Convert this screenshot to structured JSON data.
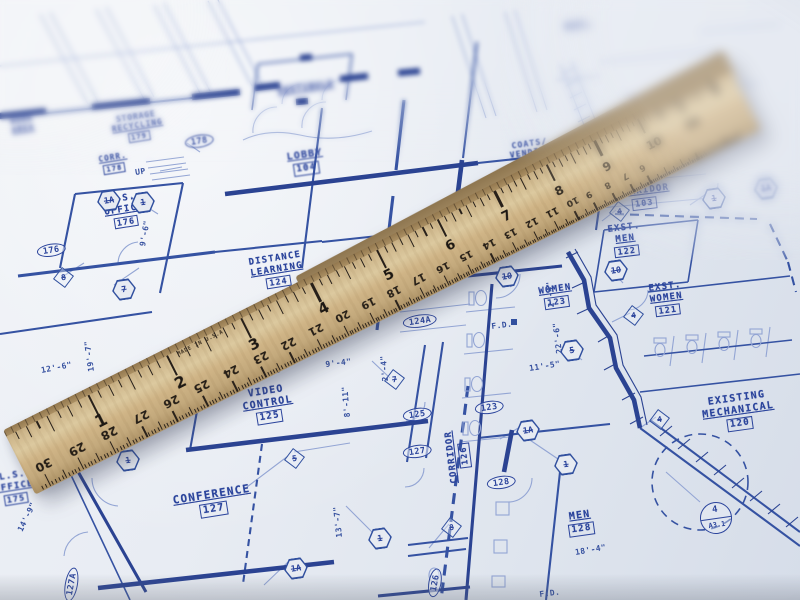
{
  "colors": {
    "paper": "#e8ecf2",
    "ink": "#2b449c",
    "ink_light": "#93a5d4",
    "wood": "#cdb68c",
    "tick": "#27201a"
  },
  "blueprint": {
    "rooms": [
      {
        "lines": [
          "WORK",
          "AREA"
        ],
        "number": "",
        "x": 10,
        "y": 118,
        "r": -9,
        "fs": 7.5,
        "blur": 1.6
      },
      {
        "lines": [
          "STORAGE",
          "RECYCLING"
        ],
        "number": "179",
        "x": 110,
        "y": 117,
        "r": -9,
        "fs": 7.5,
        "blur": 0.7
      },
      {
        "lines": [
          "CORR."
        ],
        "number": "178",
        "x": 98,
        "y": 156,
        "r": -9,
        "fs": 7.5,
        "blur": 0.5
      },
      {
        "lines": [
          "L.S.",
          "OFFICE"
        ],
        "number": "176",
        "x": 102,
        "y": 197,
        "r": -9,
        "fs": 9
      },
      {
        "lines": [
          "VESTIBULE"
        ],
        "number": "",
        "x": 277,
        "y": 87,
        "r": -8,
        "fs": 8.5,
        "blur": 1.5
      },
      {
        "lines": [
          "LOBBY"
        ],
        "number": "104",
        "x": 286,
        "y": 152,
        "r": -8,
        "fs": 10,
        "blur": 0.8
      },
      {
        "lines": [
          "COATS/",
          "VENDING"
        ],
        "number": "",
        "x": 508,
        "y": 142,
        "r": -8,
        "fs": 8,
        "blur": 0.6
      },
      {
        "lines": [
          "CORRIDOR"
        ],
        "number": "103",
        "x": 616,
        "y": 189,
        "r": -7,
        "fs": 9
      },
      {
        "lines": [
          "EXST.",
          "MEN"
        ],
        "number": "122",
        "x": 607,
        "y": 225,
        "r": -7,
        "fs": 9
      },
      {
        "lines": [
          "EXST.",
          "WOMEN"
        ],
        "number": "121",
        "x": 648,
        "y": 284,
        "r": -7,
        "fs": 9
      },
      {
        "lines": [
          "DISTANCE",
          "LEARNING"
        ],
        "number": "124",
        "x": 248,
        "y": 258,
        "r": -9,
        "fs": 9
      },
      {
        "lines": [
          "WOMEN"
        ],
        "number": "123",
        "x": 538,
        "y": 287,
        "r": -8,
        "fs": 9
      },
      {
        "lines": [
          "VIDEO",
          "CONTROL"
        ],
        "number": "125",
        "x": 240,
        "y": 390,
        "r": -9,
        "fs": 10
      },
      {
        "lines": [
          "CONFERENCE"
        ],
        "number": "127",
        "x": 172,
        "y": 495,
        "r": -9,
        "fs": 11
      },
      {
        "lines": [
          "MEN"
        ],
        "number": "128",
        "x": 566,
        "y": 512,
        "r": -8,
        "fs": 10
      },
      {
        "lines": [
          "EXISTING",
          "MECHANICAL"
        ],
        "number": "120",
        "x": 700,
        "y": 398,
        "r": -8,
        "fs": 10
      },
      {
        "lines": [
          "CORRIDOR"
        ],
        "number": "126",
        "x": 450,
        "y": 484,
        "r": -97,
        "fs": 9
      },
      {
        "lines": [
          "L.S.",
          "OFFICE"
        ],
        "number": "175",
        "x": -8,
        "y": 474,
        "r": -9,
        "fs": 9,
        "blur": 0.4
      },
      {
        "lines": [
          "EXST."
        ],
        "number": "",
        "x": 564,
        "y": 22,
        "r": -8,
        "fs": 7,
        "blur": 2
      }
    ],
    "door_tags": [
      {
        "t": "178",
        "x": 184,
        "y": 137,
        "r": -9,
        "blur": 0.7
      },
      {
        "t": "176",
        "x": 36,
        "y": 246,
        "r": -9
      },
      {
        "t": "124A",
        "x": 402,
        "y": 317,
        "r": -8
      },
      {
        "t": "125",
        "x": 402,
        "y": 410,
        "r": -8
      },
      {
        "t": "127",
        "x": 402,
        "y": 447,
        "r": -8
      },
      {
        "t": "123",
        "x": 474,
        "y": 403,
        "r": -8
      },
      {
        "t": "128",
        "x": 486,
        "y": 478,
        "r": -8
      },
      {
        "t": "127A",
        "x": 62,
        "y": 600,
        "r": -80
      },
      {
        "t": "126",
        "x": 426,
        "y": 596,
        "r": -80
      }
    ],
    "hex_markers": [
      {
        "t": "1A",
        "x": 97,
        "y": 190
      },
      {
        "t": "1",
        "x": 131,
        "y": 192
      },
      {
        "t": "7",
        "x": 112,
        "y": 279
      },
      {
        "t": "1",
        "x": 116,
        "y": 450
      },
      {
        "t": "1A",
        "x": 284,
        "y": 558
      },
      {
        "t": "1",
        "x": 368,
        "y": 528
      },
      {
        "t": "1",
        "x": 554,
        "y": 454
      },
      {
        "t": "1A",
        "x": 516,
        "y": 420
      },
      {
        "t": "10",
        "x": 495,
        "y": 266
      },
      {
        "t": "10",
        "x": 604,
        "y": 260
      },
      {
        "t": "5",
        "x": 560,
        "y": 340
      },
      {
        "t": "1",
        "x": 702,
        "y": 188
      },
      {
        "t": "1A",
        "x": 754,
        "y": 178,
        "blur": 1
      }
    ],
    "diamond_markers": [
      {
        "t": "8",
        "x": 56,
        "y": 270
      },
      {
        "t": "5",
        "x": 287,
        "y": 451
      },
      {
        "t": "7",
        "x": 387,
        "y": 372
      },
      {
        "t": "8",
        "x": 444,
        "y": 520
      },
      {
        "t": "4",
        "x": 612,
        "y": 204
      },
      {
        "t": "4",
        "x": 626,
        "y": 308
      },
      {
        "t": "4",
        "x": 652,
        "y": 412
      }
    ],
    "callout": {
      "top": "4",
      "bottom": "A3.1",
      "x": 700,
      "y": 502
    },
    "dims": [
      {
        "t": "12'-6\"",
        "x": 42,
        "y": 366,
        "r": -11
      },
      {
        "t": "19'-7\"",
        "x": 96,
        "y": 362,
        "r": -98
      },
      {
        "t": "9'-6\"",
        "x": 147,
        "y": 238,
        "r": -80
      },
      {
        "t": "8\"",
        "x": 276,
        "y": 366,
        "r": -7
      },
      {
        "t": "9'-4\"",
        "x": 326,
        "y": 360,
        "r": -7
      },
      {
        "t": "8'-11\"",
        "x": 352,
        "y": 408,
        "r": -95
      },
      {
        "t": "2'-4\"",
        "x": 390,
        "y": 372,
        "r": -95
      },
      {
        "t": "2'-4\"",
        "x": 556,
        "y": 298,
        "r": -95
      },
      {
        "t": "22'-6\"",
        "x": 564,
        "y": 344,
        "r": -97
      },
      {
        "t": "11'-5\"",
        "x": 530,
        "y": 364,
        "r": -9
      },
      {
        "t": "13'-7\"",
        "x": 344,
        "y": 528,
        "r": -96
      },
      {
        "t": "14'-9\"",
        "x": 24,
        "y": 524,
        "r": -64
      },
      {
        "t": "18'-4\"",
        "x": 576,
        "y": 548,
        "r": -10
      },
      {
        "t": "UP",
        "x": 136,
        "y": 168,
        "r": -9
      },
      {
        "t": "F.D.",
        "x": 492,
        "y": 322,
        "r": -7
      },
      {
        "t": "F.D.",
        "x": 540,
        "y": 590,
        "r": -7
      }
    ]
  },
  "ruler": {
    "made_in": "MADE IN U.S.A.",
    "inch_numbers": [
      1,
      2,
      3,
      4,
      5,
      6,
      7,
      8,
      9,
      10,
      11
    ],
    "cm_numbers": [
      30,
      29,
      28,
      27,
      26,
      25,
      24,
      23,
      22,
      21,
      20,
      19,
      18,
      17,
      16,
      15,
      14,
      13,
      12,
      11,
      10,
      9,
      8,
      7,
      6
    ]
  }
}
